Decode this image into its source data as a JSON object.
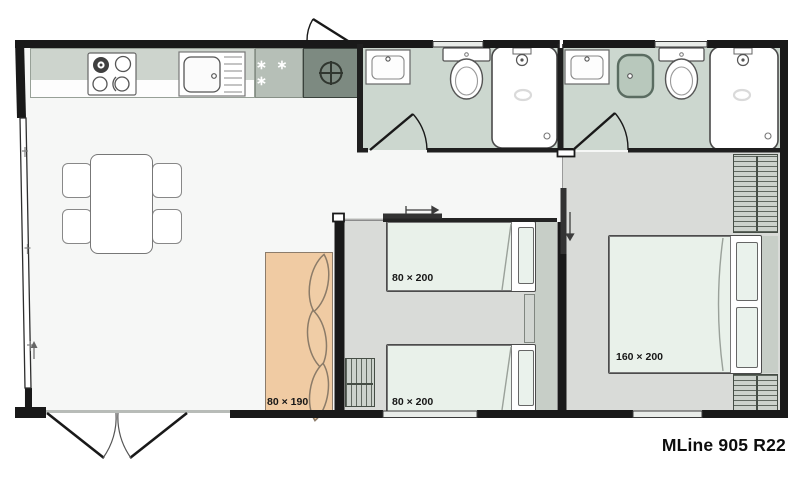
{
  "title": "MLine 905 R22",
  "labels": {
    "sofa_bed": "80 × 190",
    "single_bed_top": "80 × 200",
    "single_bed_bottom": "80 × 200",
    "double_bed": "160 × 200",
    "freezer_stars": "∗ ∗ ∗"
  },
  "rooms": [
    "kitchen",
    "living-dining",
    "bathroom-1",
    "bathroom-2",
    "children-bedroom",
    "master-bedroom"
  ],
  "fixtures": [
    "stove-icon",
    "sink-icon",
    "freezer-icon",
    "water-heater-icon",
    "washbasin-icon",
    "toilet-icon",
    "shower-icon",
    "basin-icon",
    "wardrobe-icon",
    "dining-table-icon",
    "chair-icon",
    "sofa-icon",
    "bed-icon",
    "door-swing-icon",
    "sliding-door-icon",
    "window-icon"
  ],
  "colors": {
    "wall": "#191919",
    "living_floor": "#f6f7f6",
    "bedroom_floor": "#d9dbd8",
    "bathroom_floor": "#ccd7cf",
    "mattress": "#e9f1ea",
    "sofa": "#f0cba3",
    "counter": "#cdd4cd",
    "fridge": "#b6bfb7",
    "utility": "#7d8a81",
    "wardrobe": "#ccd2cc",
    "headboard": "#c7cec7"
  }
}
